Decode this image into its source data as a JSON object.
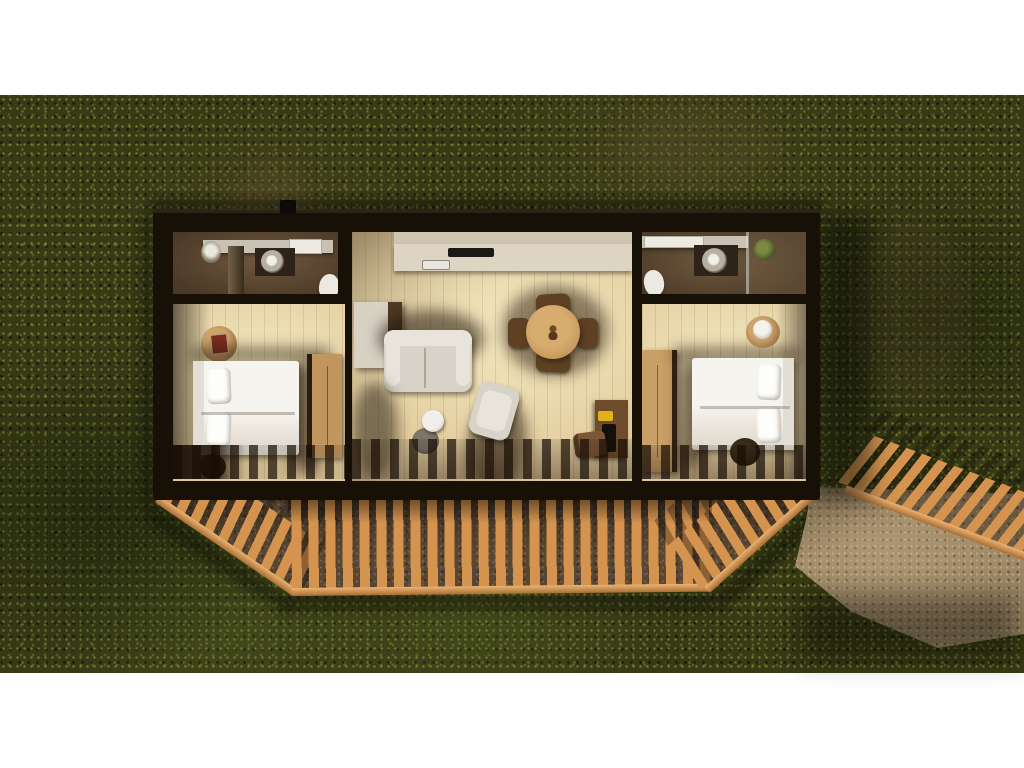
{
  "scene": {
    "description": "top-down 3d render of a rectangular cabin floor plan on dark mossy grass with a fenced gravel terrace and dirt path",
    "canvas": {
      "width": 1024,
      "height": 768
    },
    "grass_band": {
      "top": 95,
      "bottom": 673
    }
  },
  "colors": {
    "grass_base": "#383a16",
    "gravel_base": "#80694d",
    "gravel_bright": "#9d8766",
    "rail_wood": "#d4944f",
    "rail_wood_light": "#ecb473",
    "rail_wood_dark": "#a96e35",
    "wall_black": "#161007",
    "bath_floor": "#4c3a28",
    "bath_floor_light": "#6e583e",
    "counter_gray": "#c9c1b4",
    "skylight_white": "#eceae2",
    "porcelain": "#ece9e2",
    "vanity_dark": "#2e2318",
    "plant_green": "#5e6c33",
    "closet_floor": "#241c13",
    "shelf_light": "#d7d2c8",
    "shelf_mid": "#a8a095",
    "wood_floor": "#e2cd9e",
    "wood_floor_lit": "#f3e7bf",
    "kitchen_counter": "#ddd4c2",
    "kitchen_upper": "#cfc6b2",
    "cooktop_black": "#1b1916",
    "sink_white": "#e9e6df",
    "cabinet_cream": "#d8d2c5",
    "cabinet_side": "#4f3a24",
    "sofa_cream": "#d8d3c8",
    "sofa_light": "#e8e4db",
    "shadow_warm": "rgba(30,17,6,0.55)",
    "table_wood": "#c79a5e",
    "table_wood_dark": "#a87c42",
    "chair_wood": "#5e4122",
    "desk_wood": "#6e4c2c",
    "desk_chair": "#7b5738",
    "accent_yellow": "#e0b11f",
    "object_black": "#15100b",
    "bed_white": "#f6f4ef",
    "bed_fold": "#dcd6cb",
    "headboard": "#e3ded4",
    "wardrobe_wood": "#c0955e",
    "side_table_white": "#f1efe9",
    "side_table_gray": "#6b635a",
    "pouf_dark": "#1f160d",
    "book_red": "#7c2d1f",
    "lamp_white": "#f4f2ec"
  },
  "rooms": [
    {
      "name": "bathroom-left",
      "fixtures": [
        "vanity-counter",
        "round-sink",
        "toilet",
        "orchid-plant",
        "partition-wall",
        "skylight"
      ]
    },
    {
      "name": "laundry-closet",
      "fixtures": [
        "shelf-stack"
      ]
    },
    {
      "name": "living-kitchen",
      "fixtures": [
        "upper-cabinets",
        "kitchen-counter",
        "cooktop",
        "kitchen-sink",
        "side-cabinet",
        "sofa",
        "side-table-two-tier",
        "armchair",
        "round-dining-table",
        "four-dining-chairs",
        "desk",
        "desk-lamp-yellow",
        "desk-chair"
      ]
    },
    {
      "name": "bathroom-right",
      "fixtures": [
        "vanity-counter",
        "round-sink",
        "toilet",
        "shower-glass",
        "plant"
      ]
    },
    {
      "name": "bedroom-left",
      "fixtures": [
        "double-bed",
        "headboard",
        "pillows",
        "round-bedside-table",
        "red-book",
        "wardrobe",
        "dark-stool"
      ]
    },
    {
      "name": "bedroom-right",
      "fixtures": [
        "double-bed",
        "headboard",
        "pillows",
        "round-bedside-table",
        "lamp",
        "wardrobe",
        "dark-pouf"
      ]
    }
  ],
  "exterior": [
    "grass-lawn",
    "gravel-terrace",
    "dirt-path",
    "wood-baluster-fence-left-diagonal",
    "wood-baluster-fence-bottom",
    "wood-baluster-fence-right-diagonal",
    "wood-baluster-fence-outer-right",
    "chimney-vent",
    "cast-shadows"
  ]
}
